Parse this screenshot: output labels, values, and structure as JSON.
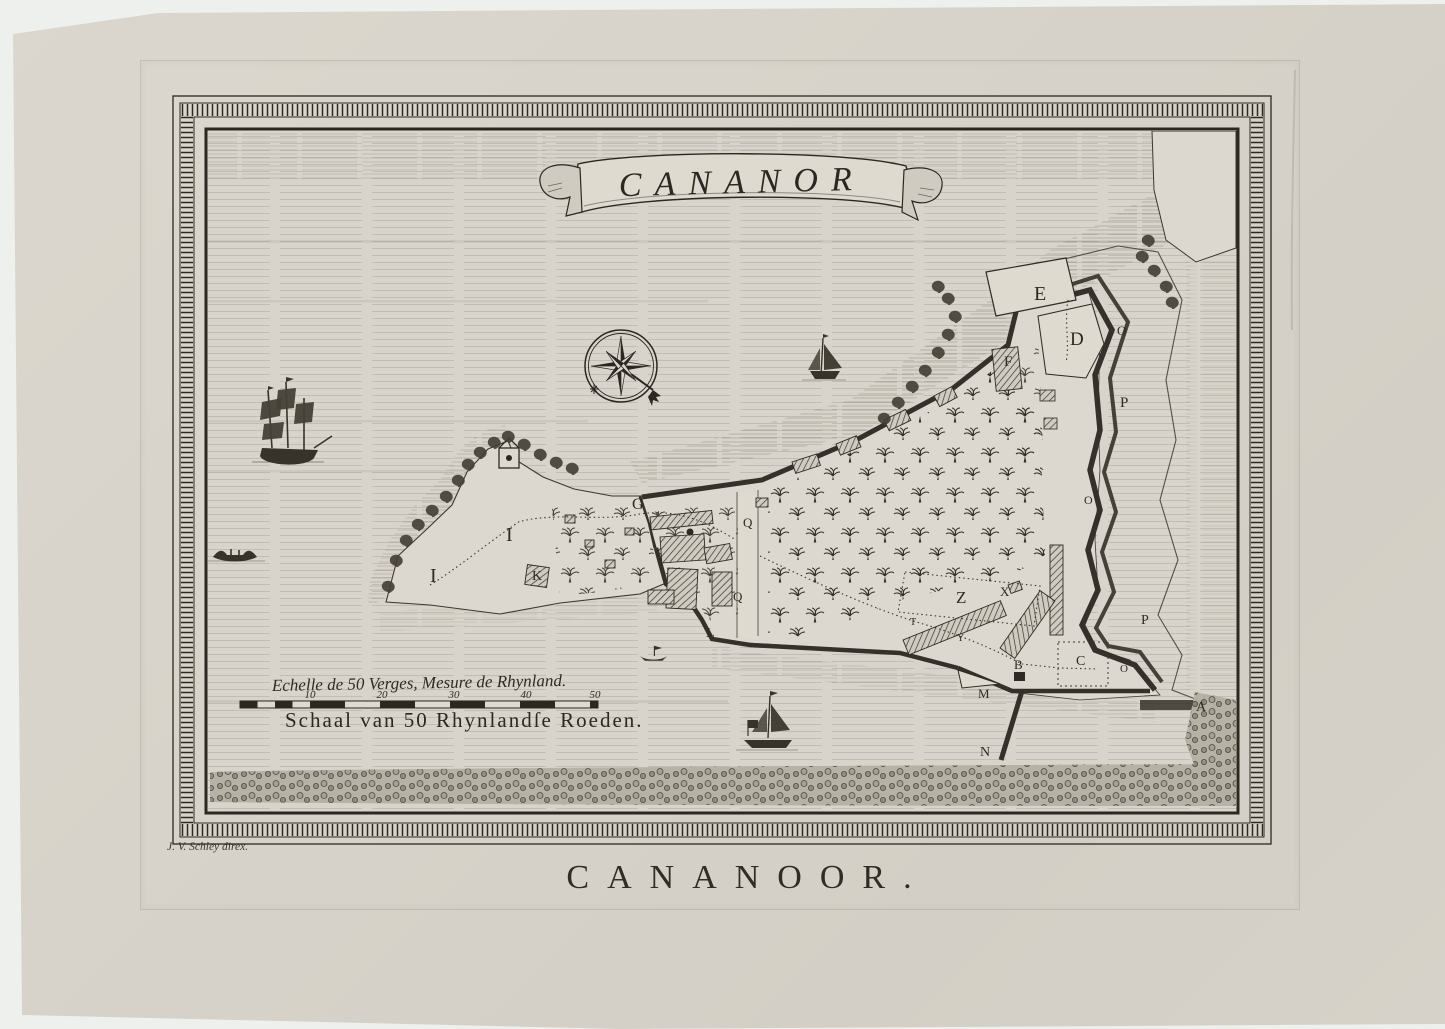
{
  "artwork": {
    "banner_title": "CANANOR",
    "bottom_title": "CANANOOR.",
    "signature": "J. V. Schley direx.",
    "scale": {
      "french_label": "Echelle de 50 Verges, Mesure de Rhynland.",
      "dutch_label": "Schaal van 50 Rhynlandſe Roeden.",
      "ticks": [
        "10",
        "20",
        "30",
        "40",
        "50"
      ]
    },
    "labels": [
      {
        "char": "E"
      },
      {
        "char": "D"
      },
      {
        "char": "O"
      },
      {
        "char": "P"
      },
      {
        "char": "F"
      },
      {
        "char": "G"
      },
      {
        "char": "I"
      },
      {
        "char": "I"
      },
      {
        "char": "K"
      },
      {
        "char": "L"
      },
      {
        "char": "Q"
      },
      {
        "char": "Q"
      },
      {
        "char": "Z"
      },
      {
        "char": "X"
      },
      {
        "char": "Y"
      },
      {
        "char": "T"
      },
      {
        "char": "B"
      },
      {
        "char": "C"
      },
      {
        "char": "O"
      },
      {
        "char": "O"
      },
      {
        "char": "P"
      },
      {
        "char": "M"
      },
      {
        "char": "N"
      },
      {
        "char": "A"
      }
    ],
    "colors": {
      "paper": "#d7d3ca",
      "ink": "#2b2822",
      "wall": "#35312a",
      "background": "#eef0ee"
    }
  }
}
